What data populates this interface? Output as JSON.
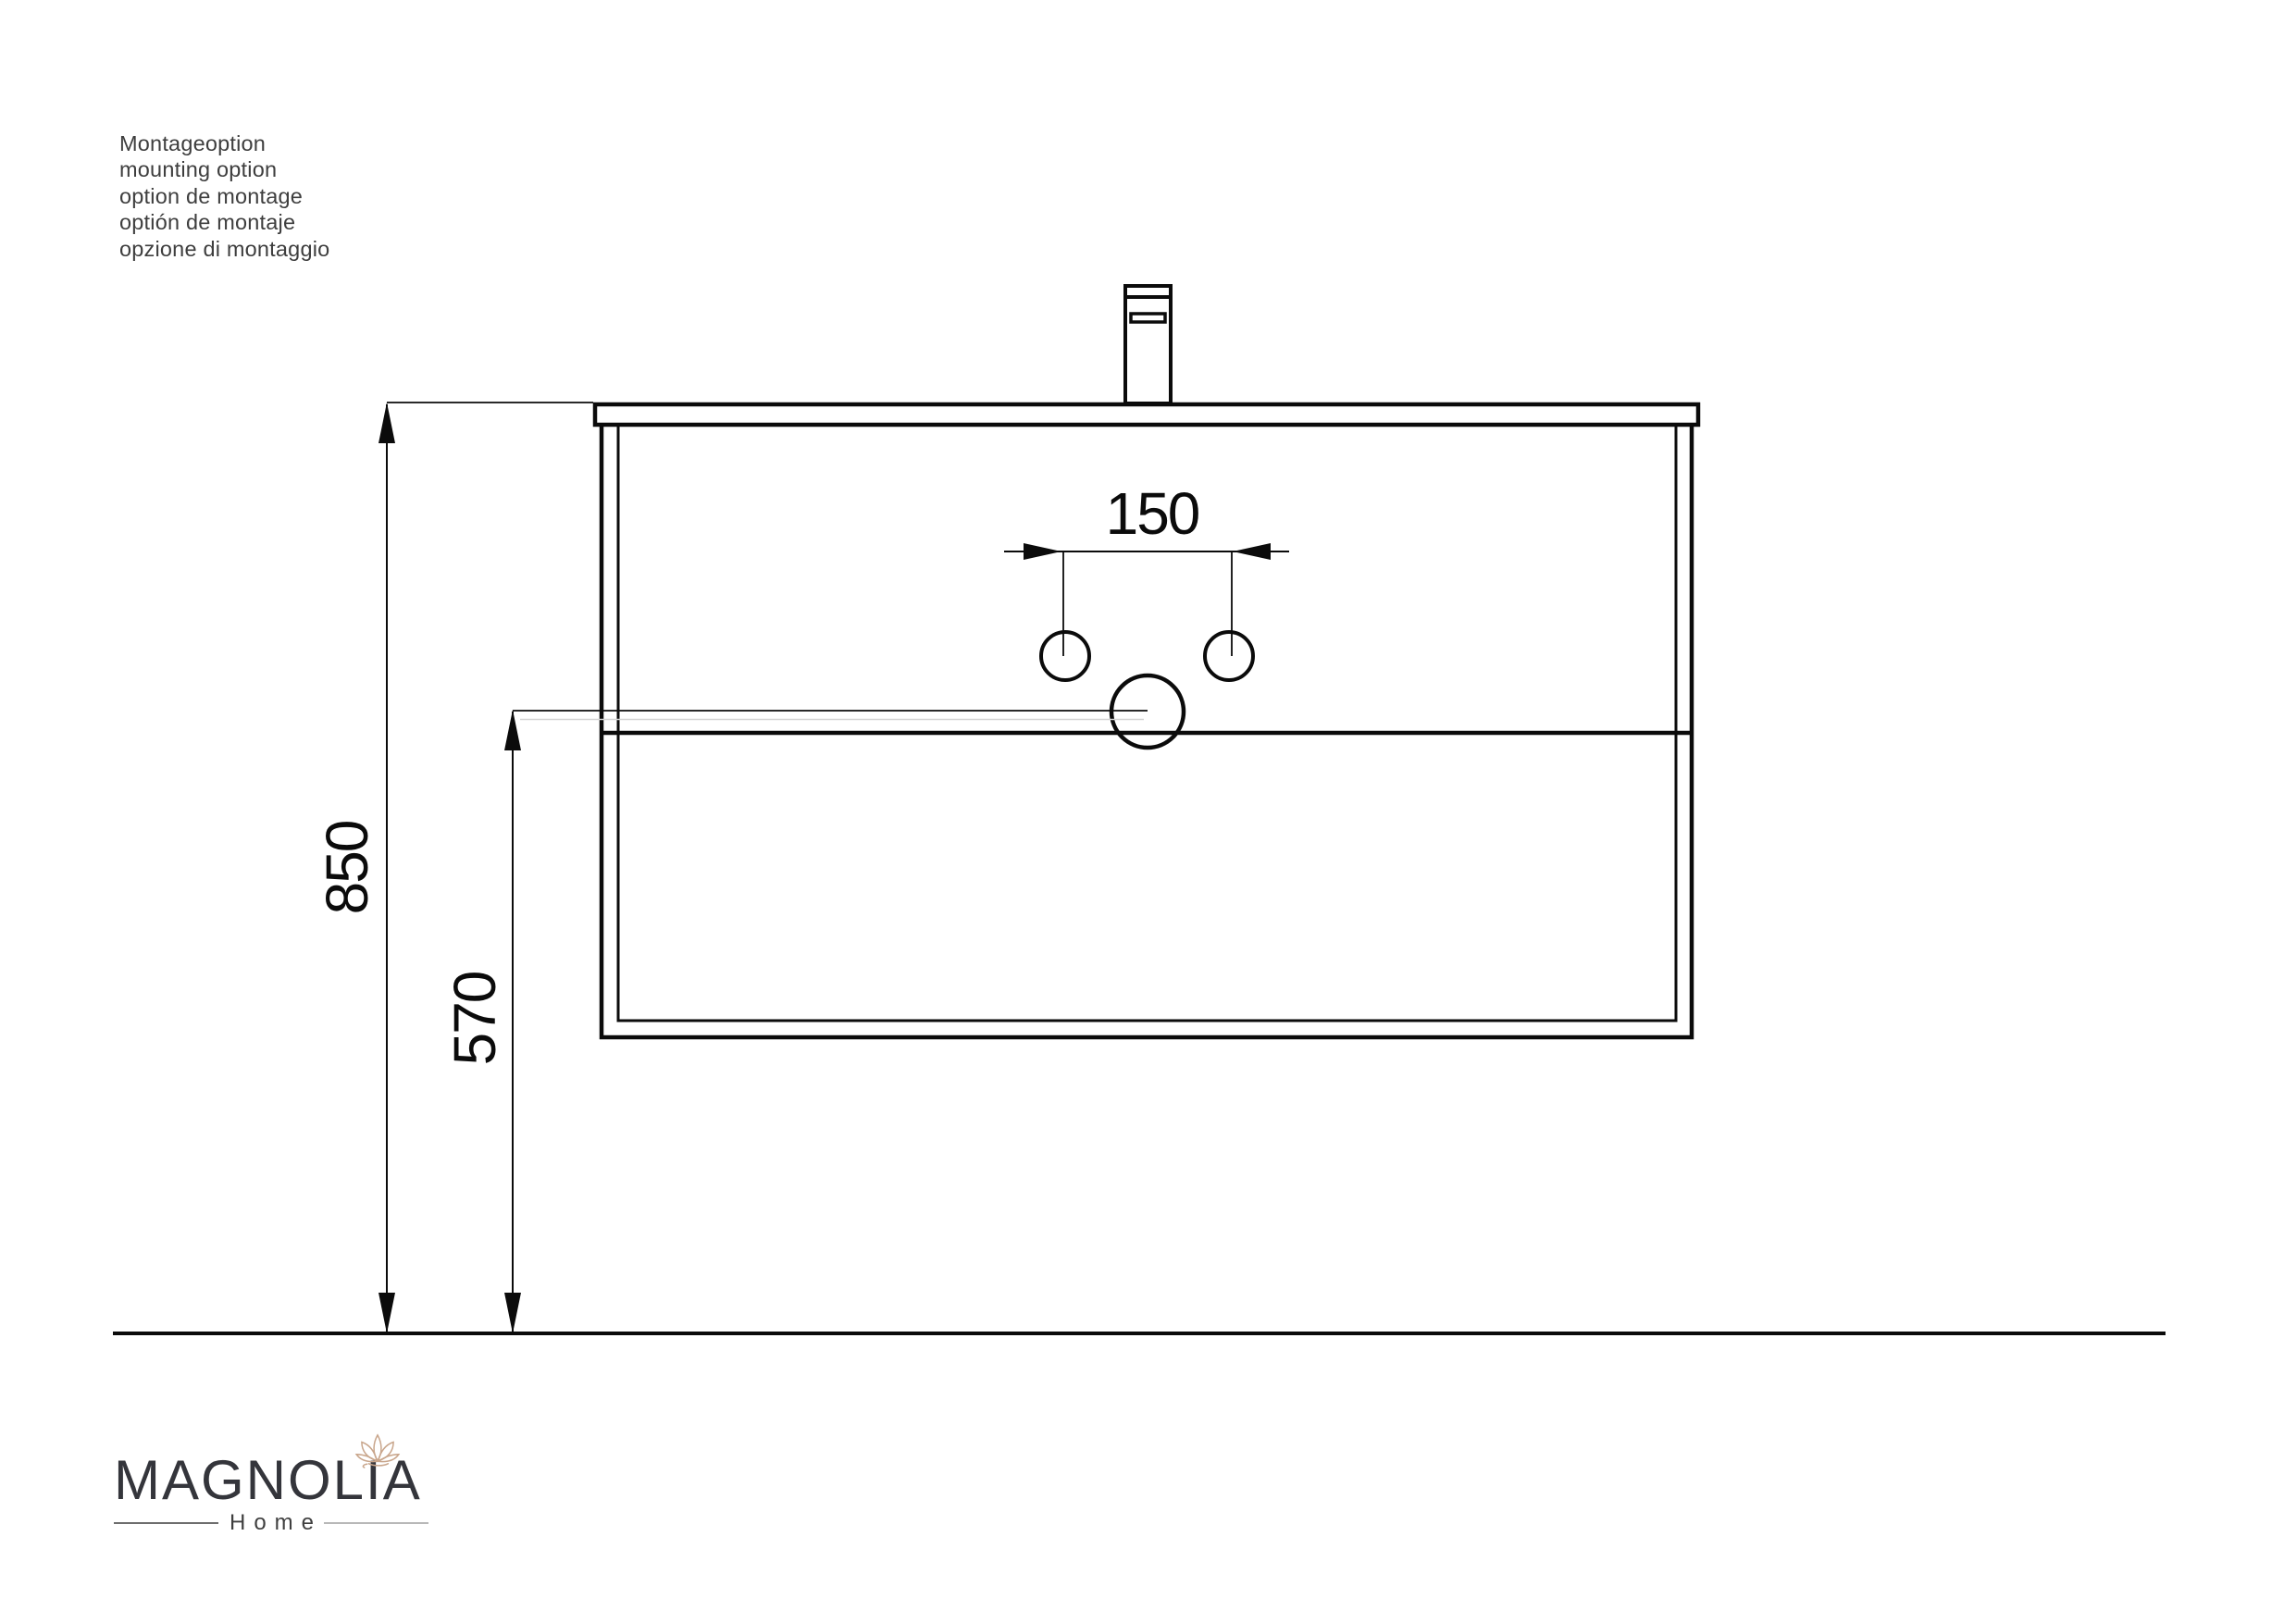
{
  "notes": {
    "lines": [
      "Montageoption",
      "mounting option",
      "option de montage",
      "optión de montaje",
      "opzione di montaggio"
    ]
  },
  "diagram": {
    "dim_hole_spacing_mm": "150",
    "dim_overall_height_mm": "850",
    "dim_drain_height_mm": "570"
  },
  "logo": {
    "brand": "MAGNOLIA",
    "tagline": "Home"
  },
  "colors": {
    "drawing_line": "#0b0b0b",
    "note_text": "#3e3e3e",
    "brand_text": "#34353b",
    "flower_accent": "#c9a68c"
  }
}
